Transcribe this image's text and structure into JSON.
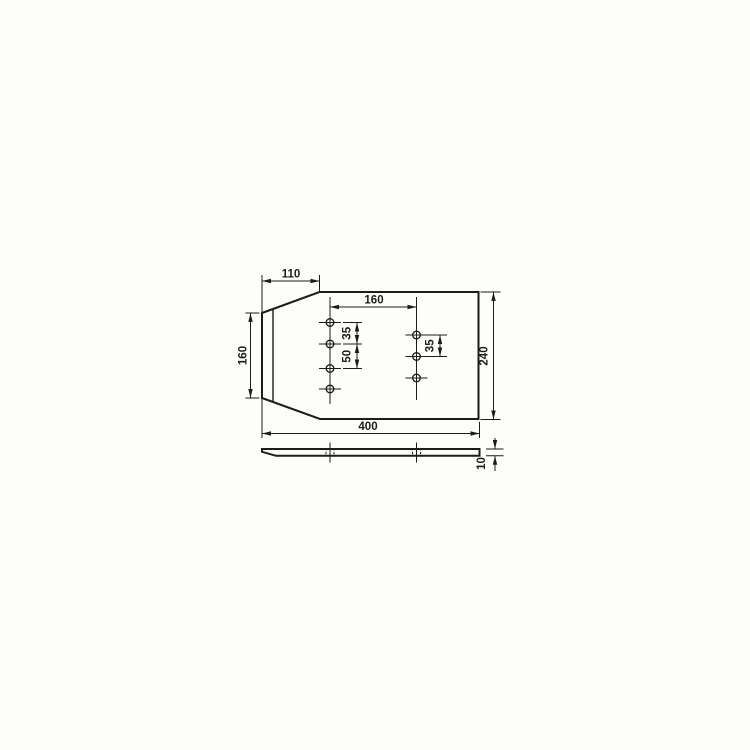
{
  "canvas": {
    "background": "#fdfdfc",
    "ink": "#1d1c17"
  },
  "drawing": {
    "type": "technical-drawing",
    "views": {
      "top_view": "plate plan view with chamfered left end",
      "side_view": "plate thickness profile with tapered left tip"
    },
    "holes": {
      "left_column_count": 4,
      "right_column_count": 3
    },
    "dimensions": {
      "chamfer_length": "110",
      "end_height": "160",
      "hole_columns_spacing": "160",
      "left_pitch_a": "35",
      "left_pitch_b": "50",
      "right_pitch": "35",
      "plate_width": "240",
      "plate_length": "400",
      "plate_thickness": "10"
    }
  }
}
